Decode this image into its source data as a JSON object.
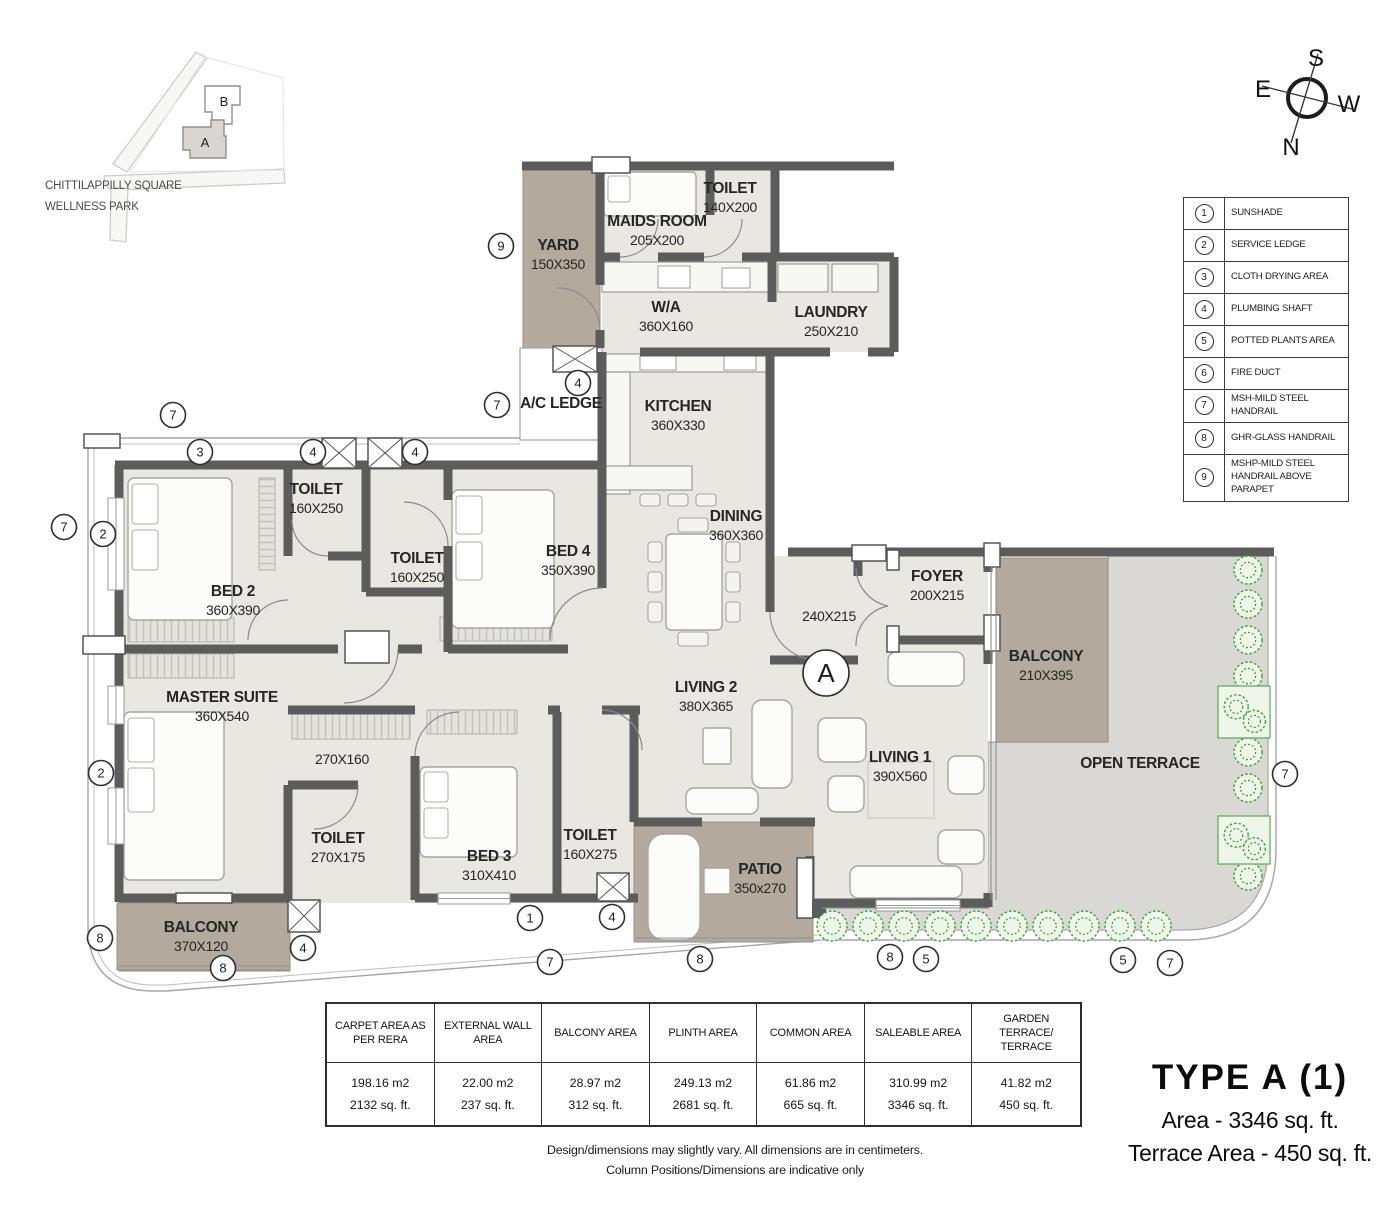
{
  "site_map": {
    "caption_line1": "CHITTILAPPILLY SQUARE",
    "caption_line2": "WELLNESS PARK",
    "building_a": "A",
    "building_b": "B"
  },
  "compass": {
    "north": "N",
    "south": "S",
    "east": "E",
    "west": "W"
  },
  "legend": {
    "items": [
      {
        "num": "1",
        "label": "SUNSHADE"
      },
      {
        "num": "2",
        "label": "SERVICE LEDGE"
      },
      {
        "num": "3",
        "label": "CLOTH DRYING AREA"
      },
      {
        "num": "4",
        "label": "PLUMBING SHAFT"
      },
      {
        "num": "5",
        "label": "POTTED PLANTS AREA"
      },
      {
        "num": "6",
        "label": "FIRE DUCT"
      },
      {
        "num": "7",
        "label": "MSH-MILD STEEL HANDRAIL"
      },
      {
        "num": "8",
        "label": "GHR-GLASS HANDRAIL"
      },
      {
        "num": "9",
        "label": "MSHP-MILD STEEL HANDRAIL ABOVE PARAPET"
      }
    ]
  },
  "floor_plan": {
    "rooms": [
      {
        "name": "YARD",
        "dims": "150X350",
        "x": 558,
        "y": 250
      },
      {
        "name": "MAIDS ROOM",
        "dims": "205X200",
        "x": 657,
        "y": 226
      },
      {
        "name": "TOILET",
        "dims": "140X200",
        "x": 730,
        "y": 193
      },
      {
        "name": "W/A",
        "dims": "360X160",
        "x": 666,
        "y": 312
      },
      {
        "name": "LAUNDRY",
        "dims": "250X210",
        "x": 831,
        "y": 317
      },
      {
        "name": "A/C LEDGE",
        "dims": "",
        "x": 561,
        "y": 408
      },
      {
        "name": "KITCHEN",
        "dims": "360X330",
        "x": 678,
        "y": 411
      },
      {
        "name": "DINING",
        "dims": "360X360",
        "x": 736,
        "y": 521
      },
      {
        "name": "TOILET",
        "dims": "160X250",
        "x": 316,
        "y": 494
      },
      {
        "name": "TOILET",
        "dims": "160X250",
        "x": 417,
        "y": 563
      },
      {
        "name": "BED 2",
        "dims": "360X390",
        "x": 233,
        "y": 596
      },
      {
        "name": "BED 4",
        "dims": "350X390",
        "x": 568,
        "y": 556
      },
      {
        "name": "MASTER SUITE",
        "dims": "360X540",
        "x": 222,
        "y": 702
      },
      {
        "name": "",
        "dims": "270X160",
        "x": 342,
        "y": 764
      },
      {
        "name": "TOILET",
        "dims": "270X175",
        "x": 338,
        "y": 843
      },
      {
        "name": "BED 3",
        "dims": "310X410",
        "x": 489,
        "y": 861
      },
      {
        "name": "TOILET",
        "dims": "160X275",
        "x": 590,
        "y": 840
      },
      {
        "name": "LIVING 2",
        "dims": "380X365",
        "x": 706,
        "y": 692
      },
      {
        "name": "LIVING 1",
        "dims": "390X560",
        "x": 900,
        "y": 762
      },
      {
        "name": "FOYER",
        "dims": "200X215",
        "x": 937,
        "y": 581
      },
      {
        "name": "",
        "dims": "240X215",
        "x": 829,
        "y": 621
      },
      {
        "name": "BALCONY",
        "dims": "210X395",
        "x": 1046,
        "y": 661
      },
      {
        "name": "OPEN TERRACE",
        "dims": "",
        "x": 1140,
        "y": 768
      },
      {
        "name": "PATIO",
        "dims": "350x270",
        "x": 760,
        "y": 874
      },
      {
        "name": "BALCONY",
        "dims": "370X120",
        "x": 201,
        "y": 932
      }
    ],
    "markers": [
      {
        "n": "9",
        "x": 501,
        "y": 246
      },
      {
        "n": "7",
        "x": 64,
        "y": 527
      },
      {
        "n": "2",
        "x": 103,
        "y": 534
      },
      {
        "n": "7",
        "x": 173,
        "y": 415
      },
      {
        "n": "3",
        "x": 200,
        "y": 452
      },
      {
        "n": "4",
        "x": 313,
        "y": 452
      },
      {
        "n": "4",
        "x": 415,
        "y": 452
      },
      {
        "n": "7",
        "x": 497,
        "y": 405
      },
      {
        "n": "4",
        "x": 578,
        "y": 383
      },
      {
        "n": "2",
        "x": 101,
        "y": 773
      },
      {
        "n": "8",
        "x": 100,
        "y": 938
      },
      {
        "n": "8",
        "x": 223,
        "y": 968
      },
      {
        "n": "4",
        "x": 303,
        "y": 948
      },
      {
        "n": "1",
        "x": 530,
        "y": 918
      },
      {
        "n": "7",
        "x": 550,
        "y": 962
      },
      {
        "n": "4",
        "x": 612,
        "y": 917
      },
      {
        "n": "8",
        "x": 700,
        "y": 959
      },
      {
        "n": "8",
        "x": 890,
        "y": 957
      },
      {
        "n": "5",
        "x": 926,
        "y": 959
      },
      {
        "n": "5",
        "x": 1123,
        "y": 960
      },
      {
        "n": "7",
        "x": 1170,
        "y": 963
      },
      {
        "n": "7",
        "x": 1285,
        "y": 774
      }
    ],
    "section_marker": {
      "label": "A"
    },
    "colors": {
      "wall": "#5c5c5c",
      "floor": "#e9e7e2",
      "outdoor": "#b3a99c",
      "terrace": "#d9d8d4",
      "plant": "#3aa23a"
    }
  },
  "area_table": {
    "columns": [
      {
        "header": "CARPET AREA AS PER RERA",
        "m2": "198.16 m2",
        "sqft": "2132 sq. ft."
      },
      {
        "header": "EXTERNAL WALL AREA",
        "m2": "22.00 m2",
        "sqft": "237 sq. ft."
      },
      {
        "header": "BALCONY AREA",
        "m2": "28.97 m2",
        "sqft": "312 sq. ft."
      },
      {
        "header": "PLINTH AREA",
        "m2": "249.13 m2",
        "sqft": "2681  sq. ft."
      },
      {
        "header": "COMMON AREA",
        "m2": "61.86 m2",
        "sqft": "665 sq. ft."
      },
      {
        "header": "SALEABLE  AREA",
        "m2": "310.99 m2",
        "sqft": "3346 sq. ft."
      },
      {
        "header": "GARDEN TERRACE/ TERRACE",
        "m2": "41.82 m2",
        "sqft": "450 sq. ft."
      }
    ]
  },
  "disclaimer": {
    "line1": "Design/dimensions may slightly vary. All dimensions are in centimeters.",
    "line2": "Column Positions/Dimensions are indicative only"
  },
  "title_block": {
    "type": "TYPE  A  (1)",
    "area": "Area - 3346 sq. ft.",
    "terrace_area": "Terrace Area - 450 sq. ft."
  }
}
